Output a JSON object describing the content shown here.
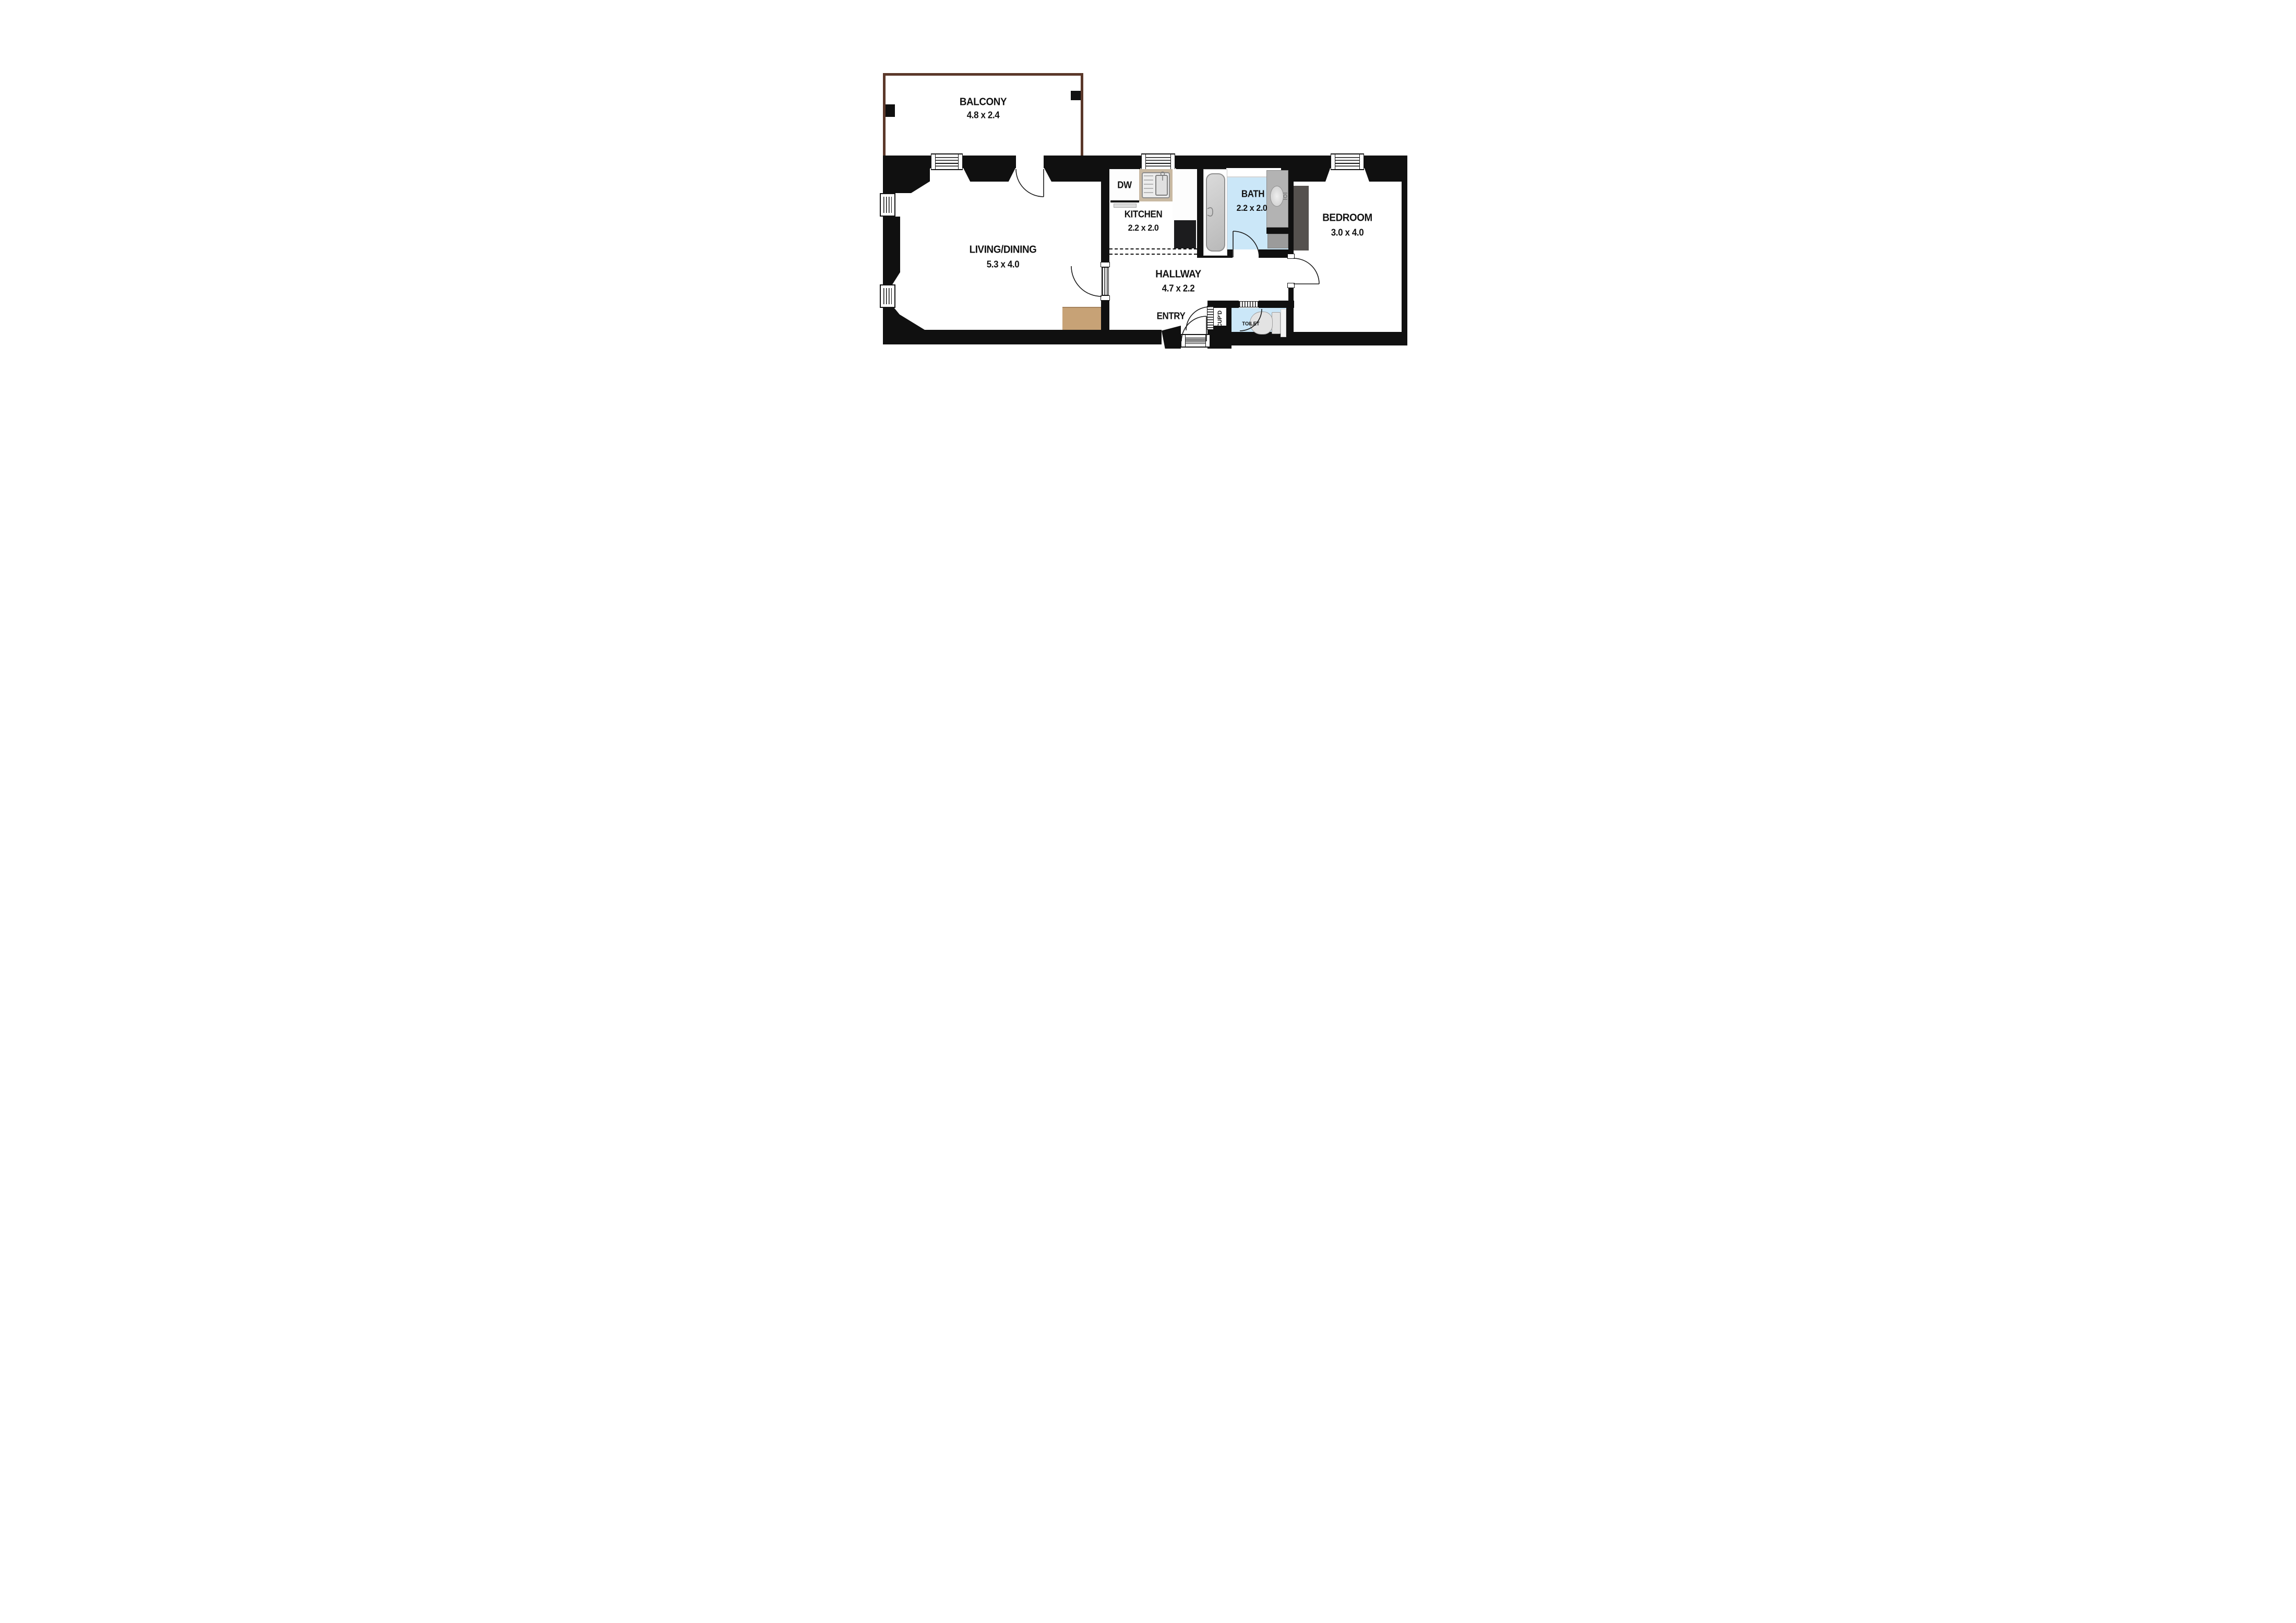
{
  "plan": {
    "type": "floor-plan",
    "rooms": {
      "balcony": {
        "name": "BALCONY",
        "dims": "4.8 x 2.4"
      },
      "living": {
        "name": "LIVING/DINING",
        "dims": "5.3 x 4.0"
      },
      "kitchen": {
        "name": "KITCHEN",
        "dims": "2.2 x 2.0"
      },
      "bath": {
        "name": "BATH",
        "dims": "2.2 x 2.0"
      },
      "bedroom": {
        "name": "BEDROOM",
        "dims": "3.0 x 4.0"
      },
      "hallway": {
        "name": "HALLWAY",
        "dims": "4.7 x 2.2"
      },
      "entry": {
        "name": "ENTRY"
      },
      "cupboard": {
        "name": "CUP'D"
      },
      "toilet": {
        "name": "TOILET"
      }
    },
    "labels": {
      "dishwasher": "DW"
    },
    "colors": {
      "wall": "#101010",
      "balcony_wall": "#5b382a",
      "bath_floor": "#cbe7f8",
      "wood_sideboard": "#c7a276",
      "sink_counter": "#c9b9a2",
      "vanity": "#b3b3b3",
      "wardrobe": "#55514e",
      "cooktop": "#1c1c1e",
      "tub": "#c9c9c9",
      "background": "#ffffff"
    },
    "fixtures": [
      "bathtub",
      "kitchen-sink",
      "dishwasher",
      "cooktop",
      "vanity-basin",
      "toilet",
      "wardrobe",
      "sideboard"
    ]
  }
}
